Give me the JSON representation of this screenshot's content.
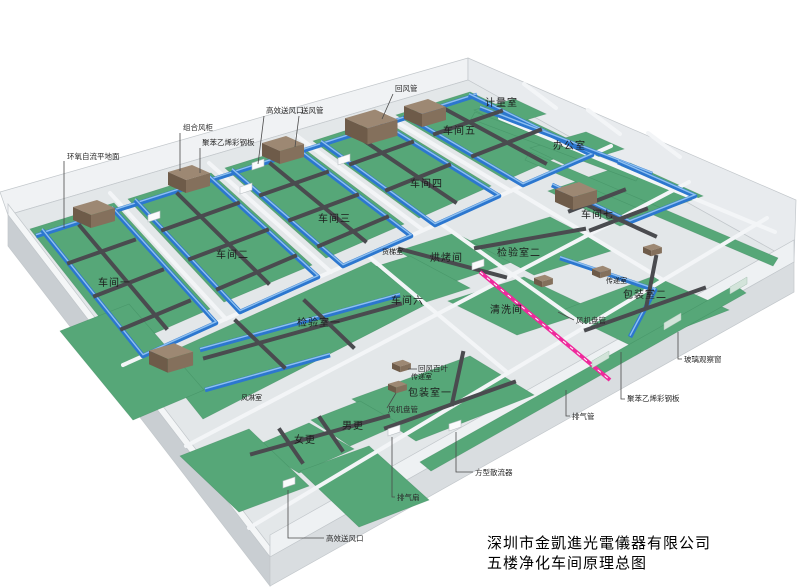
{
  "title_block": {
    "company": "深圳市金凱進光電儀器有限公司",
    "drawing": "五楼净化车间原理总图"
  },
  "colors": {
    "floor_green": "#56a778",
    "floor_edge": "#3e8a5f",
    "duct_blue": "#2c77cf",
    "duct_blue_highlight": "#8fc0f0",
    "duct_dark": "#4a4b4f",
    "exhaust_pink": "#ef2a9c",
    "ahu_brown_top": "#9d8873",
    "ahu_brown_front": "#6e5b49",
    "ahu_brown_side": "#84705c",
    "wall_white": "#f3f5f7",
    "slab_gray": "#e3e7e9"
  },
  "rooms": [
    {
      "id": "workshop-1",
      "label": "车间一",
      "x": 98,
      "y": 279
    },
    {
      "id": "workshop-2",
      "label": "车间二",
      "x": 216,
      "y": 251
    },
    {
      "id": "workshop-3",
      "label": "车间三",
      "x": 318,
      "y": 215
    },
    {
      "id": "workshop-4",
      "label": "车间四",
      "x": 410,
      "y": 180
    },
    {
      "id": "workshop-5",
      "label": "车间五",
      "x": 443,
      "y": 127
    },
    {
      "id": "workshop-6",
      "label": "车间六",
      "x": 391,
      "y": 297
    },
    {
      "id": "workshop-7",
      "label": "车间七",
      "x": 581,
      "y": 211
    },
    {
      "id": "metering-room",
      "label": "计量室",
      "x": 485,
      "y": 99
    },
    {
      "id": "office",
      "label": "办公室",
      "x": 553,
      "y": 142
    },
    {
      "id": "freight-elevator-room",
      "label": "货梯室",
      "x": 382,
      "y": 249,
      "small": true
    },
    {
      "id": "baking-room",
      "label": "烘烤间",
      "x": 430,
      "y": 254
    },
    {
      "id": "inspection-room-2",
      "label": "检验室二",
      "x": 497,
      "y": 249
    },
    {
      "id": "cleaning-room",
      "label": "清洗间",
      "x": 490,
      "y": 306
    },
    {
      "id": "packing-room-2",
      "label": "包装室二",
      "x": 623,
      "y": 291
    },
    {
      "id": "inspection-room-1",
      "label": "检验室一",
      "x": 297,
      "y": 319
    },
    {
      "id": "packing-room-1",
      "label": "包装室一",
      "x": 408,
      "y": 389
    },
    {
      "id": "transfer-room-1",
      "label": "传递室",
      "x": 411,
      "y": 374,
      "small": true
    },
    {
      "id": "transfer-room-2",
      "label": "传递室",
      "x": 606,
      "y": 278,
      "small": true
    },
    {
      "id": "air-shower-room",
      "label": "风淋室",
      "x": 241,
      "y": 395,
      "small": true
    },
    {
      "id": "mens-changing",
      "label": "男更",
      "x": 342,
      "y": 422
    },
    {
      "id": "womens-changing",
      "label": "女更",
      "x": 294,
      "y": 436
    }
  ],
  "callouts": [
    {
      "id": "epoxy-self-leveling-floor",
      "label": "环氧自流平地面",
      "x": 67,
      "y": 153,
      "line": [
        [
          64,
          161
        ],
        [
          64,
          228
        ]
      ]
    },
    {
      "id": "combined-air-handling-unit",
      "label": "组合风柜",
      "x": 183,
      "y": 124,
      "line": [
        [
          180,
          133
        ],
        [
          180,
          171
        ]
      ]
    },
    {
      "id": "polystyrene-steel-panel-top",
      "label": "聚苯乙烯彩钢板",
      "x": 202,
      "y": 139,
      "line": [
        [
          200,
          148
        ],
        [
          200,
          173
        ]
      ]
    },
    {
      "id": "hepa-supply-outlet-top",
      "label": "高效送风口",
      "x": 266,
      "y": 107,
      "line": [
        [
          264,
          116
        ],
        [
          258,
          164
        ]
      ]
    },
    {
      "id": "supply-air-duct",
      "label": "送风管",
      "x": 301,
      "y": 107,
      "line": [
        [
          299,
          116
        ],
        [
          295,
          147
        ]
      ]
    },
    {
      "id": "return-air-duct",
      "label": "回风管",
      "x": 395,
      "y": 85,
      "line": [
        [
          393,
          94
        ],
        [
          382,
          119
        ]
      ]
    },
    {
      "id": "return-air-louver",
      "label": "回风百叶",
      "x": 418,
      "y": 365,
      "small": true,
      "line": [
        [
          417,
          369
        ],
        [
          408,
          369
        ]
      ]
    },
    {
      "id": "fan-coil-unit-1",
      "label": "风机盘管",
      "x": 388,
      "y": 406,
      "small": true,
      "line": [
        [
          387,
          408
        ],
        [
          396,
          393
        ]
      ]
    },
    {
      "id": "fan-coil-unit-2",
      "label": "风机盘管",
      "x": 576,
      "y": 317,
      "small": true,
      "line": [
        [
          574,
          320
        ],
        [
          558,
          312
        ]
      ]
    },
    {
      "id": "glass-observation-window",
      "label": "玻璃观察窗",
      "x": 684,
      "y": 356,
      "line": [
        [
          682,
          359
        ],
        [
          678,
          359
        ],
        [
          678,
          332
        ]
      ]
    },
    {
      "id": "polystyrene-steel-panel-right",
      "label": "聚苯乙烯彩钢板",
      "x": 627,
      "y": 395,
      "line": [
        [
          625,
          399
        ],
        [
          621,
          399
        ],
        [
          621,
          352
        ]
      ]
    },
    {
      "id": "exhaust-pipe",
      "label": "排气管",
      "x": 572,
      "y": 413,
      "line": [
        [
          570,
          416
        ],
        [
          566,
          416
        ],
        [
          566,
          390
        ]
      ]
    },
    {
      "id": "square-diffuser",
      "label": "方型散流器",
      "x": 475,
      "y": 469,
      "line": [
        [
          473,
          472
        ],
        [
          456,
          472
        ],
        [
          456,
          432
        ]
      ]
    },
    {
      "id": "exhaust-fan",
      "label": "排气扇",
      "x": 397,
      "y": 494,
      "line": [
        [
          395,
          497
        ],
        [
          392,
          497
        ],
        [
          392,
          437
        ]
      ]
    },
    {
      "id": "hepa-supply-outlet-bottom",
      "label": "高效送风口",
      "x": 326,
      "y": 535,
      "line": [
        [
          324,
          538
        ],
        [
          288,
          538
        ],
        [
          288,
          490
        ]
      ]
    }
  ]
}
